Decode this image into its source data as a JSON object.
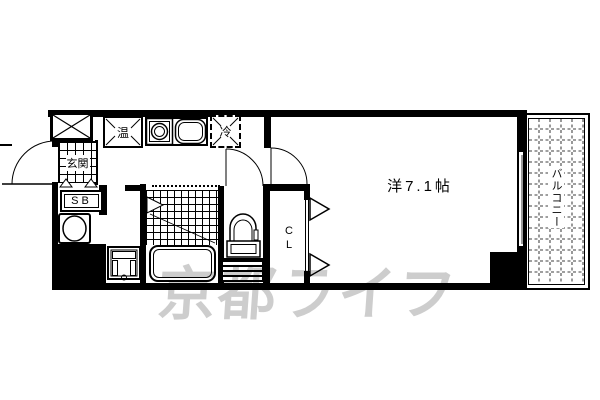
{
  "floorplan": {
    "entrance": {
      "label": "玄関"
    },
    "shoe_box": {
      "label": "SB"
    },
    "kitchen": {
      "water_heater_label": "温",
      "refrigerator_label": "冷"
    },
    "closet": {
      "label": "CL"
    },
    "main_room": {
      "label": "洋7.1帖"
    },
    "balcony": {
      "label": "バルコニー"
    }
  },
  "watermark": {
    "text": "京都ライフ"
  },
  "colors": {
    "line": "#000000",
    "watermark_gray": "#cdcdcd",
    "background": "#ffffff"
  }
}
